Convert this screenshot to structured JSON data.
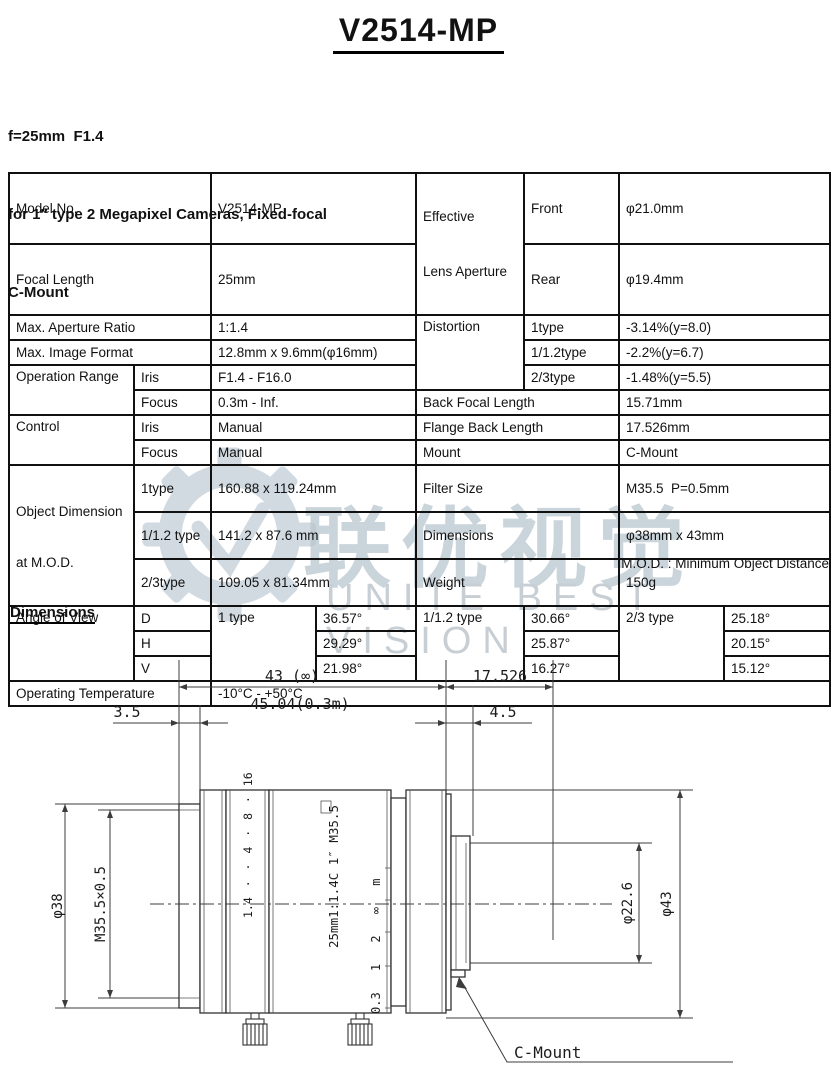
{
  "header": {
    "title": "V2514-MP",
    "subtitle_lines": [
      "f=25mm  F1.4",
      "for 1″ type 2 Megapixel Cameras, Fixed-focal",
      "C-Mount"
    ]
  },
  "watermark": {
    "cjk": "联优视觉",
    "latin": "UNITE BEST VISION",
    "color": "#b9c6cf"
  },
  "spec": {
    "model": {
      "label": "Model No.",
      "value": "V2514-MP"
    },
    "focal": {
      "label": "Focal Length",
      "value": "25mm"
    },
    "aperture_ratio": {
      "label": "Max. Aperture Ratio",
      "value": "1:1.4"
    },
    "image_format": {
      "label": "Max. Image Format",
      "value": "12.8mm x 9.6mm(φ16mm)"
    },
    "operation_range": {
      "label": "Operation Range",
      "iris_label": "Iris",
      "iris": "F1.4 - F16.0",
      "focus_label": "Focus",
      "focus": "0.3m - Inf."
    },
    "control": {
      "label": "Control",
      "iris_label": "Iris",
      "iris": "Manual",
      "focus_label": "Focus",
      "focus": "Manual"
    },
    "object_dimension": {
      "label_line1": "Object Dimension",
      "label_line2": "at M.O.D.",
      "t1_label": "1type",
      "t1": "160.88 x 119.24mm",
      "t112_label": "1/1.2 type",
      "t112": "141.2 x 87.6 mm",
      "t23_label": "2/3type",
      "t23": "109.05 x 81.34mm"
    },
    "effective_aperture": {
      "label_line1": "Effective",
      "label_line2": "Lens Aperture",
      "front_label": "Front",
      "front": "φ21.0mm",
      "rear_label": "Rear",
      "rear": "φ19.4mm"
    },
    "distortion": {
      "label": "Distortion",
      "t1_label": "1type",
      "t1": "-3.14%(y=8.0)",
      "t112_label": "1/1.2type",
      "t112": "-2.2%(y=6.7)",
      "t23_label": "2/3type",
      "t23": "-1.48%(y=5.5)"
    },
    "back_focal": {
      "label": "Back Focal Length",
      "value": "15.71mm"
    },
    "flange_back": {
      "label": "Flange Back Length",
      "value": "17.526mm"
    },
    "mount": {
      "label": "Mount",
      "value": "C-Mount"
    },
    "filter_size": {
      "label": "Filter Size",
      "value": "M35.5  P=0.5mm"
    },
    "dimensions": {
      "label": "Dimensions",
      "value": "φ38mm x 43mm"
    },
    "weight": {
      "label": "Weight",
      "value": "150g"
    },
    "angle_of_view": {
      "label": "Angle of View",
      "t1_label": "1 type",
      "t112_label": "1/1.2 type",
      "t23_label": "2/3 type",
      "d_label": "D",
      "h_label": "H",
      "v_label": "V",
      "d": {
        "t1": "36.57°",
        "t112": "30.66°",
        "t23": "25.18°"
      },
      "h": {
        "t1": "29.29°",
        "t112": "25.87°",
        "t23": "20.15°"
      },
      "v": {
        "t1": "21.98°",
        "t112": "16.27°",
        "t23": "15.12°"
      }
    },
    "operating_temp": {
      "label": "Operating Temperature",
      "value": "-10°C - +50°C"
    }
  },
  "notes": {
    "mod": "M.O.D. : Minimum Object Distance",
    "dimensions_heading": "Dimensions"
  },
  "drawing": {
    "dims": {
      "len_inf": "43 (∞)",
      "len_03m": "45.04(0.3m)",
      "front_protrusion": "3.5",
      "flange_back": "17.526",
      "rear_len": "4.5",
      "front_dia": "φ38",
      "filter_thread": "M35.5×0.5",
      "rear_dia": "φ22.6",
      "mount_dia": "φ43"
    },
    "markings": {
      "aperture_scale": "1.4 · · 4 · 8 · 16",
      "barrel": "25mm1:1.4C 1″ M35.5",
      "focus_scale": "0.3 1 2 ∞ m"
    },
    "mount_label": "C-Mount"
  }
}
